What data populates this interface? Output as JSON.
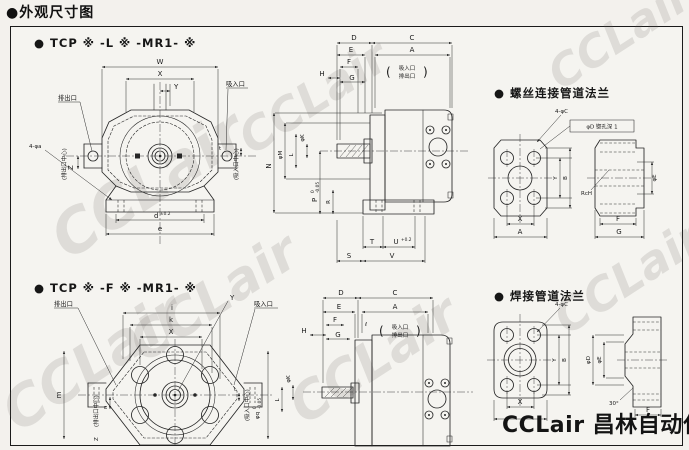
{
  "page": {
    "title": "●外观尺寸图"
  },
  "sections": {
    "tcp_l": "● TCP ※ -L ※ -MR1- ※",
    "screw": "● 螺丝连接管道法兰",
    "tcp_f": "● TCP ※ -F ※ -MR1- ※",
    "weld": "● 焊接管道法兰"
  },
  "brand": {
    "logo": "CCLair 昌林自动化",
    "watermark": "CCLair"
  },
  "front_l": {
    "discharge": "排出口",
    "suction": "吸入口",
    "discharge_center": "(排出口中心)",
    "suction_center": "(吸入口中心)",
    "w": "W",
    "x": "X",
    "y": "Y",
    "z": "Z",
    "t": "t",
    "d": "d",
    "d_tol": "±0.2",
    "e": "e",
    "holes": "4-φa"
  },
  "side_l": {
    "d": "D",
    "c": "C",
    "e": "E",
    "a": "A",
    "f": "F",
    "h": "H",
    "g": "G",
    "n": "N",
    "m": "φM",
    "k": "φK",
    "l": "L",
    "p": "P",
    "p_hi": "0",
    "p_lo": "-0.05",
    "r": "R",
    "t": "T",
    "u": "U",
    "u_tol": "+0.2",
    "s": "S",
    "v": "V",
    "port1": "吸入口",
    "port2": "排出口",
    "paren_l": "(",
    "paren_r": ")"
  },
  "screw_view": {
    "holes": "4-φC",
    "cbore": "φD 锪孔深 1",
    "y": "Y",
    "b": "B",
    "x": "X",
    "a": "A",
    "thread": "RcH",
    "e": "φE",
    "f": "F",
    "g": "G"
  },
  "front_f": {
    "discharge": "排出口",
    "suction": "吸入口",
    "discharge_center": "(排出口中心)",
    "suction_center": "(吸入口中心)",
    "y": "Y",
    "i": "i",
    "k": "k",
    "x": "X",
    "m": "m",
    "z": "Z",
    "n": "n",
    "t": "t",
    "q": "φq",
    "q_hi": "0",
    "q_lo": "-0.05"
  },
  "side_f": {
    "d": "D",
    "c": "C",
    "e": "E",
    "a": "A",
    "f": "F",
    "l_small": "ℓ",
    "h": "H",
    "g": "G",
    "k": "φK",
    "l": "L",
    "port1": "吸入口",
    "port2": "排出口",
    "paren_l": "(",
    "paren_r": ")"
  },
  "weld_view": {
    "holes": "4-φC",
    "y": "Y",
    "b": "B",
    "x": "X",
    "d": "φD",
    "e": "φE",
    "angle": "30°",
    "f": "F"
  }
}
